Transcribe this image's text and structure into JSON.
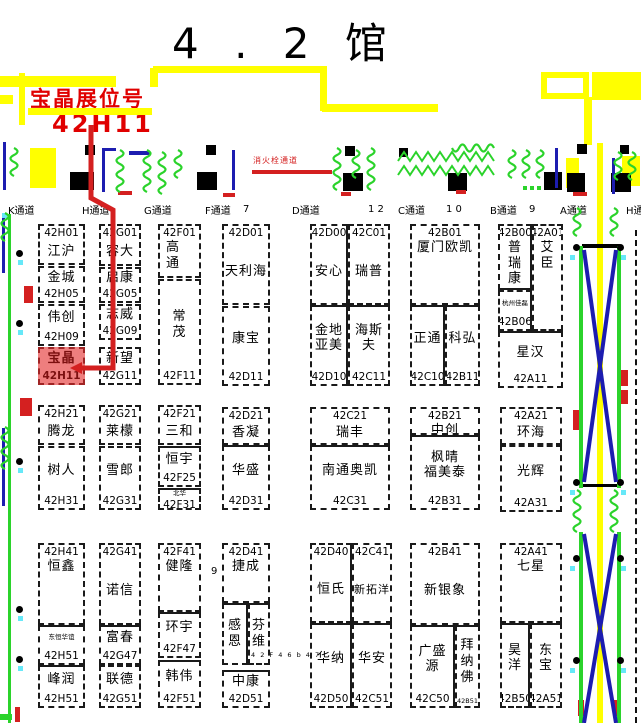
{
  "title": "4 . 2 馆",
  "banner": {
    "line1": "宝晶展位号",
    "line2": "42H11"
  },
  "fire_label": "消火栓通道",
  "colors": {
    "yellow": "#ffff00",
    "black": "#000000",
    "red": "#d42020",
    "blue": "#1d1db0",
    "green": "#2bd32b",
    "cyan": "#66e8f8",
    "highlight": "#ee7e7e",
    "banner_red": "#e00000"
  },
  "aisles": [
    {
      "label": "K通道",
      "x": 8
    },
    {
      "label": "H通道",
      "x": 82
    },
    {
      "label": "G通道",
      "x": 144
    },
    {
      "label": "F通道",
      "x": 205
    },
    {
      "label": "D通道",
      "x": 292
    },
    {
      "label": "C通道",
      "x": 398
    },
    {
      "label": "B通道",
      "x": 490
    },
    {
      "label": "A通道",
      "x": 560
    },
    {
      "label": "H通",
      "x": 626
    }
  ],
  "dims": [
    {
      "t": "7",
      "x": 243,
      "y": 204
    },
    {
      "t": "1 2",
      "x": 368,
      "y": 204
    },
    {
      "t": "1 0",
      "x": 446,
      "y": 204
    },
    {
      "t": "9",
      "x": 529,
      "y": 204
    },
    {
      "t": "9",
      "x": 211,
      "y": 566
    },
    {
      "t": "4 2 F 4 6 b 4 7",
      "x": 251,
      "y": 651,
      "tiny": true
    }
  ],
  "booths": [
    {
      "num": "42H01",
      "name": "江沪",
      "np": "top",
      "x": 38,
      "y": 224,
      "w": 47,
      "h": 41
    },
    {
      "num": "42H05",
      "name": "金城",
      "np": "bot",
      "x": 38,
      "y": 266,
      "w": 47,
      "h": 37
    },
    {
      "num": "42H09",
      "name": "伟创",
      "np": "bot",
      "x": 38,
      "y": 304,
      "w": 47,
      "h": 42
    },
    {
      "num": "42H11",
      "name": "宝晶",
      "np": "bot",
      "x": 38,
      "y": 347,
      "w": 47,
      "h": 38,
      "hl": true
    },
    {
      "num": "42G01",
      "name": "容大",
      "np": "top",
      "x": 99,
      "y": 224,
      "w": 42,
      "h": 42
    },
    {
      "num": "42G05",
      "name": "启康",
      "np": "bot",
      "x": 99,
      "y": 267,
      "w": 42,
      "h": 36
    },
    {
      "num": "42G09",
      "name": "志威",
      "np": "bot",
      "x": 99,
      "y": 304,
      "w": 42,
      "h": 36
    },
    {
      "num": "42G11",
      "name": "新望",
      "np": "bot",
      "x": 99,
      "y": 347,
      "w": 42,
      "h": 38
    },
    {
      "num": "42F01",
      "name": "高通",
      "vert": true,
      "np": "top",
      "nameTop": true,
      "alignL": true,
      "x": 158,
      "y": 224,
      "w": 43,
      "h": 54
    },
    {
      "num": "42F11",
      "name": "常茂",
      "vert": true,
      "np": "bot",
      "x": 158,
      "y": 279,
      "w": 43,
      "h": 106
    },
    {
      "num": "42D01",
      "name": "天利海",
      "np": "top",
      "x": 222,
      "y": 224,
      "w": 48,
      "h": 81
    },
    {
      "num": "42D11",
      "name": "康宝",
      "np": "bot",
      "x": 222,
      "y": 306,
      "w": 48,
      "h": 80
    },
    {
      "num": "42D00",
      "name": "安心",
      "np": "top",
      "x": 310,
      "y": 224,
      "w": 38,
      "h": 81,
      "sides": {
        "r": "s"
      }
    },
    {
      "num": "42C01",
      "name": "瑞普",
      "np": "top",
      "x": 348,
      "y": 224,
      "w": 42,
      "h": 81
    },
    {
      "num": "42D10",
      "lines": [
        "金地",
        "亚美"
      ],
      "np": "bot",
      "x": 310,
      "y": 305,
      "w": 38,
      "h": 81,
      "sides": {
        "t": "s",
        "r": "s"
      }
    },
    {
      "num": "42C11",
      "lines": [
        "海斯",
        "夫"
      ],
      "np": "bot",
      "x": 348,
      "y": 305,
      "w": 42,
      "h": 81,
      "sides": {
        "t": "s"
      }
    },
    {
      "num": "42B01",
      "name": "厦门欧凯",
      "np": "top",
      "nameTop": true,
      "x": 410,
      "y": 224,
      "w": 70,
      "h": 81
    },
    {
      "num": "42C10",
      "name": "正通",
      "np": "bot",
      "x": 410,
      "y": 305,
      "w": 35,
      "h": 81,
      "sides": {
        "t": "s",
        "r": "s"
      }
    },
    {
      "num": "42B11",
      "name": "科弘",
      "np": "bot",
      "x": 445,
      "y": 305,
      "w": 35,
      "h": 81,
      "sides": {
        "t": "s"
      }
    },
    {
      "num": "42B00",
      "name": "普瑞康",
      "vert": true,
      "np": "top",
      "nameTop": true,
      "x": 498,
      "y": 224,
      "w": 34,
      "h": 66,
      "sides": {
        "r": "s",
        "b": "s"
      }
    },
    {
      "num": "42A01",
      "name": "艾臣",
      "vert": true,
      "np": "top",
      "nameTop": true,
      "x": 532,
      "y": 224,
      "w": 31,
      "h": 107
    },
    {
      "num": "42B06",
      "name": "杭州佳磊",
      "small": true,
      "np": "bot",
      "x": 498,
      "y": 290,
      "w": 34,
      "h": 41,
      "sides": {
        "r": "s"
      }
    },
    {
      "num": "42A11",
      "name": "星汉",
      "np": "bot",
      "x": 498,
      "y": 331,
      "w": 65,
      "h": 57,
      "sides": {
        "t": "s"
      }
    },
    {
      "num": "42H21",
      "name": "腾龙",
      "np": "top",
      "x": 38,
      "y": 405,
      "w": 47,
      "h": 40
    },
    {
      "num": "42H31",
      "name": "树人",
      "np": "bot",
      "x": 38,
      "y": 446,
      "w": 47,
      "h": 64
    },
    {
      "num": "42G21",
      "name": "莱檬",
      "np": "top",
      "x": 99,
      "y": 405,
      "w": 42,
      "h": 40
    },
    {
      "num": "42G31",
      "name": "雪郎",
      "np": "bot",
      "x": 99,
      "y": 446,
      "w": 42,
      "h": 64
    },
    {
      "num": "42F21",
      "name": "三和",
      "np": "top",
      "x": 158,
      "y": 405,
      "w": 43,
      "h": 40
    },
    {
      "num": "42F25",
      "name": "恒宇",
      "np": "bot",
      "x": 158,
      "y": 446,
      "w": 43,
      "h": 41,
      "sides": {
        "t": "s"
      }
    },
    {
      "num": "42F31",
      "name": "北华",
      "small": true,
      "np": "bot",
      "x": 158,
      "y": 488,
      "w": 43,
      "h": 22,
      "sides": {
        "t": "s"
      }
    },
    {
      "num": "42D21",
      "name": "香凝",
      "np": "top",
      "x": 222,
      "y": 407,
      "w": 48,
      "h": 38
    },
    {
      "num": "42D31",
      "name": "华盛",
      "np": "bot",
      "x": 222,
      "y": 445,
      "w": 48,
      "h": 65,
      "sides": {
        "t": "s"
      }
    },
    {
      "num": "42C21",
      "name": "瑞丰",
      "np": "top",
      "x": 310,
      "y": 407,
      "w": 80,
      "h": 38
    },
    {
      "num": "42C31",
      "name": "南通奥凯",
      "np": "bot",
      "x": 310,
      "y": 445,
      "w": 80,
      "h": 65,
      "sides": {
        "t": "s"
      }
    },
    {
      "num": "42B21",
      "name": "中创",
      "np": "top",
      "x": 410,
      "y": 407,
      "w": 70,
      "h": 28
    },
    {
      "num": "42B31",
      "lines": [
        "枫晴",
        "福美泰"
      ],
      "np": "bot",
      "x": 410,
      "y": 435,
      "w": 70,
      "h": 75,
      "sides": {
        "t": "s"
      }
    },
    {
      "num": "42A21",
      "name": "环海",
      "np": "top",
      "x": 500,
      "y": 407,
      "w": 62,
      "h": 38
    },
    {
      "num": "42A31",
      "name": "光辉",
      "np": "bot",
      "x": 500,
      "y": 445,
      "w": 62,
      "h": 67
    },
    {
      "num": "42H41",
      "name": "恒鑫",
      "np": "top",
      "nameTop": true,
      "x": 38,
      "y": 543,
      "w": 47,
      "h": 82
    },
    {
      "num": "42H51",
      "name": "东恒华谊",
      "small": true,
      "np": "bot",
      "x": 38,
      "y": 625,
      "w": 47,
      "h": 40,
      "sides": {
        "t": "s"
      }
    },
    {
      "num": "42H51",
      "name": "峰润",
      "np": "bot",
      "x": 38,
      "y": 665,
      "w": 47,
      "h": 43,
      "sides": {
        "t": "s"
      }
    },
    {
      "num": "42G41",
      "name": "诺信",
      "np": "top",
      "x": 99,
      "y": 543,
      "w": 42,
      "h": 82
    },
    {
      "num": "42G47",
      "name": "富春",
      "np": "bot",
      "x": 99,
      "y": 625,
      "w": 42,
      "h": 40,
      "sides": {
        "t": "s"
      }
    },
    {
      "num": "42G51",
      "name": "联德",
      "np": "bot",
      "x": 99,
      "y": 665,
      "w": 42,
      "h": 43
    },
    {
      "num": "42F41",
      "name": "健隆",
      "np": "top",
      "nameTop": true,
      "x": 158,
      "y": 543,
      "w": 43,
      "h": 69
    },
    {
      "num": "42F47",
      "name": "环宇",
      "np": "bot",
      "x": 158,
      "y": 612,
      "w": 43,
      "h": 46,
      "sides": {
        "t": "s"
      }
    },
    {
      "num": "42F51",
      "name": "韩伟",
      "np": "bot",
      "x": 158,
      "y": 660,
      "w": 43,
      "h": 48,
      "sides": {
        "t": "s"
      }
    },
    {
      "num": "42D41",
      "name": "捷成",
      "np": "top",
      "nameTop": true,
      "x": 222,
      "y": 543,
      "w": 48,
      "h": 60
    },
    {
      "name": "感恩",
      "vert": true,
      "x": 222,
      "y": 603,
      "w": 26,
      "h": 62,
      "sides": {
        "t": "s",
        "r": "s"
      }
    },
    {
      "name": "芬维",
      "vert": true,
      "x": 248,
      "y": 603,
      "w": 22,
      "h": 62,
      "sides": {
        "t": "s"
      }
    },
    {
      "num": "42D51",
      "name": "中康",
      "np": "bot",
      "x": 222,
      "y": 670,
      "w": 48,
      "h": 38,
      "sides": {
        "t": "s"
      }
    },
    {
      "num": "42D40",
      "name": "恒氏",
      "np": "top",
      "x": 310,
      "y": 543,
      "w": 42,
      "h": 80,
      "sides": {
        "r": "s"
      }
    },
    {
      "num": "42C41",
      "name": "新拓洋",
      "fs": 11,
      "np": "top",
      "x": 352,
      "y": 543,
      "w": 40,
      "h": 80
    },
    {
      "num": "42D50",
      "name": "华纳",
      "np": "bot",
      "x": 310,
      "y": 623,
      "w": 42,
      "h": 85,
      "sides": {
        "t": "s",
        "r": "s"
      }
    },
    {
      "num": "42C51",
      "name": "华安",
      "np": "bot",
      "x": 352,
      "y": 623,
      "w": 40,
      "h": 85,
      "sides": {
        "t": "s"
      }
    },
    {
      "num": "42B41",
      "name": "新银象",
      "np": "top",
      "x": 410,
      "y": 543,
      "w": 70,
      "h": 82
    },
    {
      "num": "42C50",
      "lines": [
        "广盛",
        "源"
      ],
      "np": "bot",
      "x": 410,
      "y": 625,
      "w": 45,
      "h": 83,
      "sides": {
        "t": "s",
        "r": "s"
      }
    },
    {
      "num": "42B51",
      "name": "拜纳佛",
      "vert": true,
      "np": "bot",
      "numSmall": true,
      "x": 455,
      "y": 625,
      "w": 25,
      "h": 83,
      "sides": {
        "t": "s"
      }
    },
    {
      "num": "42A41",
      "name": "七星",
      "np": "top",
      "nameTop": true,
      "x": 500,
      "y": 543,
      "w": 62,
      "h": 80
    },
    {
      "num": "42B50",
      "name": "昊洋",
      "vert": true,
      "np": "bot",
      "x": 500,
      "y": 623,
      "w": 30,
      "h": 85,
      "sides": {
        "t": "s",
        "r": "s"
      }
    },
    {
      "num": "42A51",
      "name": "东宝",
      "vert": true,
      "np": "bot",
      "x": 530,
      "y": 623,
      "w": 32,
      "h": 85,
      "sides": {
        "t": "s"
      }
    }
  ],
  "deco": {
    "rects": {
      "yellow": [
        [
          0,
          76,
          116,
          11
        ],
        [
          28,
          108,
          124,
          7
        ],
        [
          150,
          68,
          8,
          19
        ],
        [
          153,
          66,
          172,
          7
        ],
        [
          320,
          66,
          7,
          45
        ],
        [
          322,
          104,
          116,
          8
        ],
        [
          19,
          73,
          6,
          52
        ],
        [
          0,
          95,
          13,
          9
        ],
        [
          592,
          72,
          49,
          28
        ],
        [
          584,
          97,
          8,
          48
        ],
        [
          566,
          158,
          13,
          30
        ],
        [
          622,
          156,
          18,
          30
        ],
        [
          597,
          143,
          6,
          580
        ],
        [
          30,
          148,
          26,
          40
        ]
      ],
      "black": [
        [
          85,
          145,
          10,
          10
        ],
        [
          206,
          145,
          10,
          10
        ],
        [
          345,
          146,
          10,
          10
        ],
        [
          399,
          148,
          9,
          9
        ],
        [
          577,
          144,
          10,
          10
        ],
        [
          620,
          145,
          9,
          9
        ],
        [
          70,
          172,
          24,
          18
        ],
        [
          197,
          172,
          20,
          18
        ],
        [
          343,
          173,
          20,
          18
        ],
        [
          448,
          173,
          19,
          18
        ],
        [
          544,
          172,
          18,
          18
        ],
        [
          567,
          173,
          18,
          19
        ],
        [
          611,
          173,
          20,
          19
        ],
        [
          546,
          78,
          10,
          13
        ],
        [
          582,
          244,
          38,
          4
        ],
        [
          582,
          484,
          38,
          3
        ]
      ],
      "red": [
        [
          252,
          170,
          80,
          4
        ],
        [
          118,
          191,
          14,
          4
        ],
        [
          223,
          193,
          12,
          4
        ],
        [
          341,
          192,
          10,
          4
        ],
        [
          456,
          190,
          10,
          4
        ],
        [
          573,
          192,
          14,
          4
        ],
        [
          24,
          286,
          9,
          17
        ],
        [
          20,
          398,
          12,
          18
        ],
        [
          15,
          707,
          5,
          15
        ],
        [
          573,
          410,
          8,
          20
        ],
        [
          619,
          370,
          9,
          16
        ],
        [
          619,
          390,
          9,
          14
        ],
        [
          578,
          700,
          6,
          16
        ],
        [
          614,
          700,
          6,
          16
        ]
      ],
      "blue": [
        [
          102,
          148,
          3,
          44
        ],
        [
          104,
          148,
          12,
          3
        ],
        [
          232,
          150,
          3,
          40
        ],
        [
          129,
          151,
          21,
          4
        ],
        [
          555,
          148,
          3,
          40
        ],
        [
          612,
          158,
          3,
          36
        ],
        [
          3,
          142,
          3,
          48
        ],
        [
          2,
          215,
          3,
          58
        ],
        [
          2,
          428,
          3,
          78
        ]
      ],
      "green": [
        [
          8,
          214,
          3,
          509
        ],
        [
          579,
          246,
          4,
          242
        ],
        [
          617,
          246,
          4,
          242
        ],
        [
          579,
          532,
          4,
          191
        ],
        [
          617,
          532,
          4,
          191
        ],
        [
          0,
          714,
          12,
          6
        ],
        [
          523,
          186,
          4,
          4
        ],
        [
          530,
          186,
          4,
          4
        ],
        [
          537,
          186,
          4,
          4
        ]
      ]
    },
    "outline": [
      [
        541,
        72,
        48,
        27
      ]
    ],
    "dots": [
      [
        16,
        250
      ],
      [
        16,
        320
      ],
      [
        16,
        458
      ],
      [
        16,
        606
      ],
      [
        16,
        656
      ],
      [
        573,
        244
      ],
      [
        617,
        244
      ],
      [
        573,
        479
      ],
      [
        617,
        479
      ],
      [
        573,
        555
      ],
      [
        617,
        555
      ],
      [
        573,
        657
      ],
      [
        617,
        657
      ]
    ],
    "cyans": [
      [
        18,
        260
      ],
      [
        18,
        330
      ],
      [
        18,
        468
      ],
      [
        18,
        616
      ],
      [
        18,
        666
      ],
      [
        570,
        255
      ],
      [
        621,
        255
      ],
      [
        570,
        490
      ],
      [
        621,
        490
      ],
      [
        570,
        566
      ],
      [
        621,
        566
      ],
      [
        570,
        668
      ],
      [
        621,
        668
      ],
      [
        2,
        213
      ]
    ],
    "wavesV": [
      [
        116,
        150,
        42
      ],
      [
        143,
        150,
        44
      ],
      [
        158,
        152,
        42
      ],
      [
        174,
        150,
        40
      ],
      [
        333,
        148,
        44
      ],
      [
        352,
        150,
        40
      ],
      [
        367,
        148,
        42
      ],
      [
        508,
        150,
        40
      ],
      [
        522,
        150,
        40
      ],
      [
        536,
        150,
        40
      ],
      [
        614,
        152,
        36
      ],
      [
        628,
        152,
        36
      ],
      [
        1,
        213,
        36
      ],
      [
        1,
        427,
        46
      ],
      [
        573,
        208,
        38
      ],
      [
        610,
        208,
        38
      ],
      [
        573,
        490,
        42
      ],
      [
        610,
        490,
        42
      ],
      [
        10,
        148,
        34
      ]
    ],
    "wavesH": [
      [
        452,
        144,
        48
      ]
    ],
    "hedges": [
      [
        398,
        152,
        100
      ],
      [
        398,
        166,
        100
      ]
    ],
    "xlines": [
      [
        584,
        250,
        616,
        482
      ],
      [
        616,
        250,
        584,
        482
      ],
      [
        584,
        534,
        616,
        723
      ],
      [
        616,
        534,
        584,
        723
      ]
    ],
    "pointer": [
      [
        91,
        125
      ],
      [
        91,
        198
      ],
      [
        113,
        210
      ],
      [
        113,
        368
      ],
      [
        82,
        368
      ]
    ],
    "arrow": [
      [
        82,
        362
      ],
      [
        70,
        368
      ],
      [
        82,
        374
      ]
    ],
    "dashv": [
      [
        635,
        230,
        493
      ]
    ]
  }
}
